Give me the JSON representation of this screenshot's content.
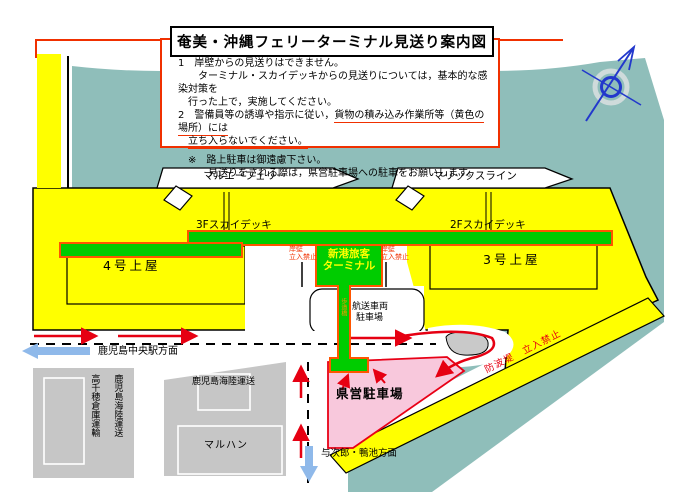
{
  "title": "奄美・沖縄フェリーターミナル見送り案内図",
  "notice": {
    "item1_line1": "1　岸壁からの見送りはできません。",
    "item1_line2": "　　ターミナル・スカイデッキからの見送りについては，基本的な感染対策を",
    "item1_line3": "　行った上で，実施してください。",
    "item2_plain": "2　警備員等の誘導や指示に従い，",
    "item2_underlined": "貨物の積み込み作業所等（黄色の場所）には",
    "item2_indent": "　",
    "item2_underlined2": "立ち入らないでください。",
    "note_line1": "　※　路上駐車は御遠慮下さい。",
    "note_line2": "　　　見送りをされる際は，県営駐車場への駐車をお願いします。"
  },
  "map": {
    "ships": [
      {
        "name": "マルエーフェリー"
      },
      {
        "name": "マリックスライン"
      }
    ],
    "decks": {
      "deck3f": "3Fスカイデッキ",
      "deck2f": "2Fスカイデッキ"
    },
    "sheds": {
      "shed4": "4号上屋",
      "shed3": "3号上屋"
    },
    "terminal": {
      "line1": "新港旅客",
      "line2": "ターミナル"
    },
    "quay_warning": {
      "line1": "岸壁",
      "line2": "立入禁止"
    },
    "walkway_label": "歩道橋",
    "vehicle_parking": {
      "line1": "航送車両",
      "line2": "駐車場"
    },
    "pref_parking": "県営駐車場",
    "breakwater_warning": "防波堤　立入禁止",
    "directions": {
      "west": "鹿児島中央駅方面",
      "south": "与次郎・鴨池方面"
    },
    "buildings": {
      "takachiho": "高千穂倉庫運輸",
      "kairiku_vertical": "鹿児島海陸運送",
      "kairiku_horizontal": "鹿児島海陸運送",
      "maruhan": "マルハン"
    }
  },
  "colors": {
    "water": "#8FBEBA",
    "wharf_yellow": "#FFFF00",
    "deck_green": "#00CC00",
    "deck_outline": "#FF5500",
    "parking_pink": "#F8C8DC",
    "parking_border": "#E80016",
    "arrow_red": "#E60012",
    "arrow_blue": "#8FB9EA",
    "notice_red": "#F03000",
    "compass_blue": "#2238CC"
  }
}
